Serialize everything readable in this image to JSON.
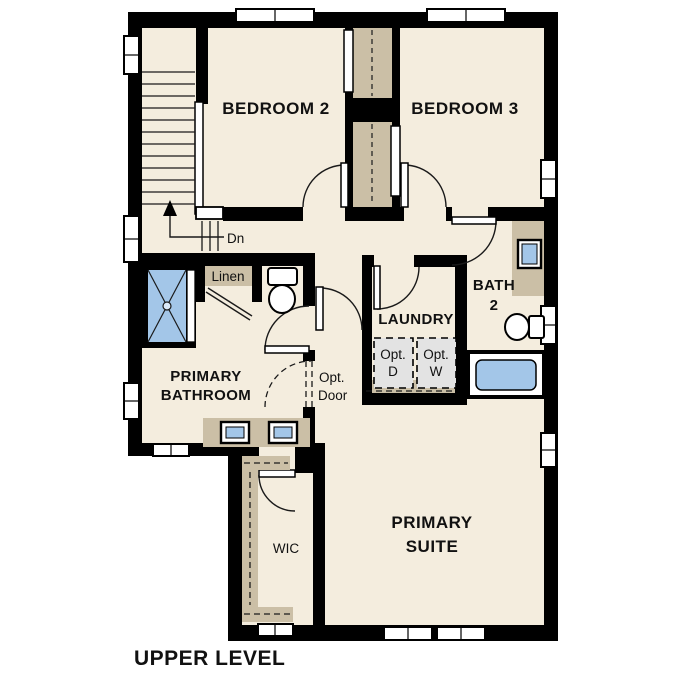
{
  "page_title": "UPPER LEVEL",
  "plan": {
    "level_label": "UPPER LEVEL",
    "rooms": {
      "bedroom2": {
        "label": "BEDROOM 2"
      },
      "bedroom3": {
        "label": "BEDROOM 3"
      },
      "primary_bathroom": {
        "line1": "PRIMARY",
        "line2": "BATHROOM"
      },
      "laundry": {
        "label": "LAUNDRY"
      },
      "bath2": {
        "line1": "BATH",
        "line2": "2"
      },
      "primary_suite": {
        "line1": "PRIMARY",
        "line2": "SUITE"
      },
      "wic": {
        "label": "WIC"
      },
      "linen": {
        "label": "Linen"
      }
    },
    "annotations": {
      "stairs_direction": "Dn",
      "optional_door": {
        "line1": "Opt.",
        "line2": "Door"
      },
      "optional_dryer": {
        "line1": "Opt.",
        "line2": "D"
      },
      "optional_washer": {
        "line1": "Opt.",
        "line2": "W"
      }
    },
    "fixtures": [
      "stairs",
      "shower",
      "toilet",
      "double-vanity-sinks",
      "vanity-sink",
      "bathtub",
      "linen-closet",
      "optional-washer-dryer"
    ],
    "colors": {
      "floor": "#f4edde",
      "wall": "#000000",
      "cabinet_tan": "#cbbfa6",
      "fixture_blue": "#a3c6e8",
      "optional_gray": "#e3e3e3",
      "background": "#ffffff"
    }
  }
}
